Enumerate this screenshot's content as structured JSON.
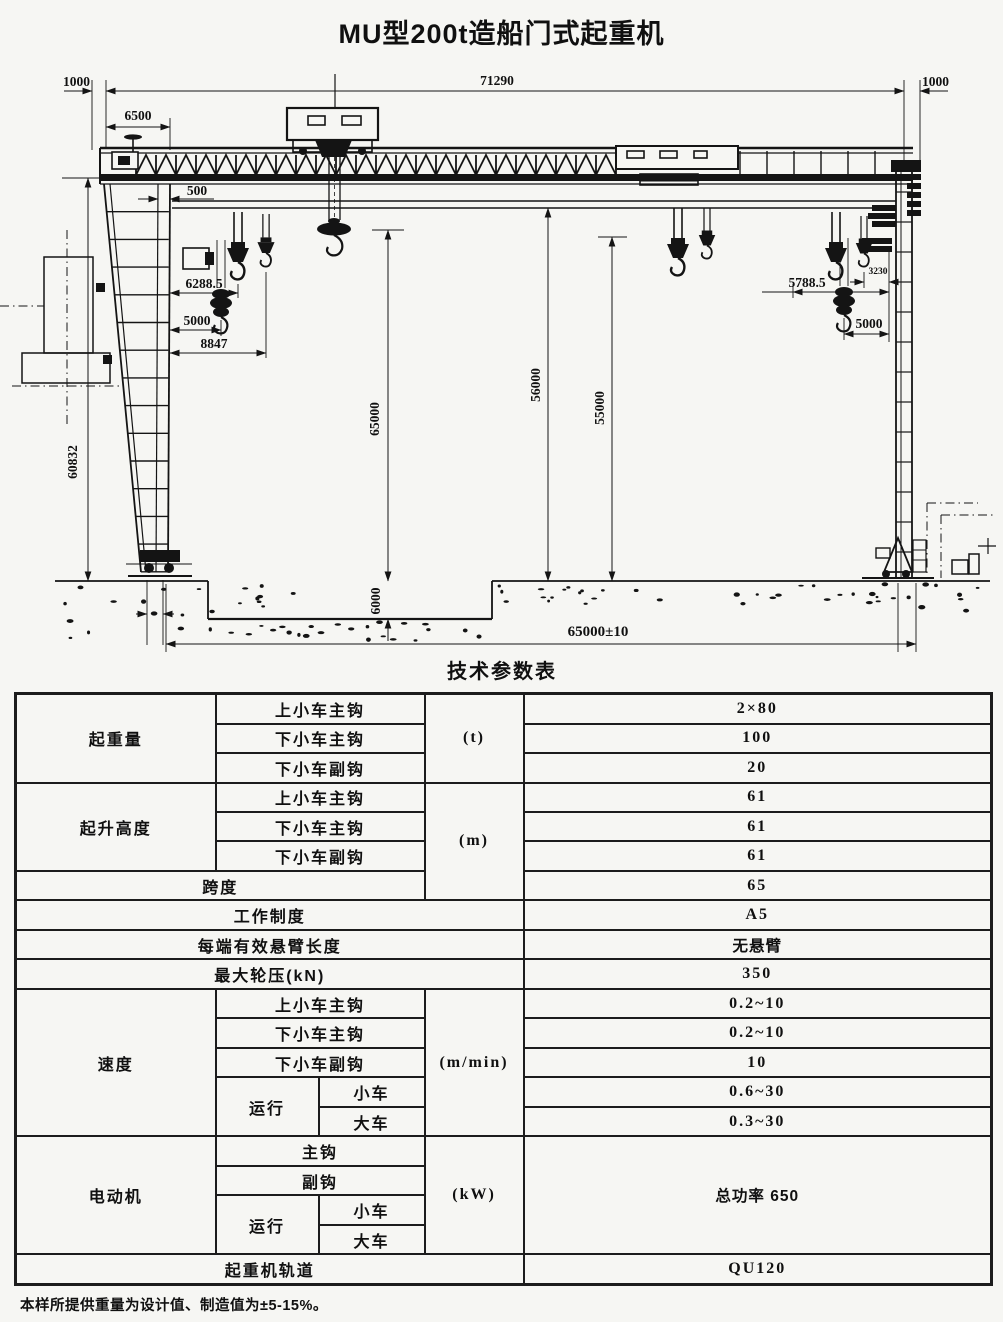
{
  "title": "MU型200t造船门式起重机",
  "dims": {
    "overhang_left": "1000",
    "overall": "71290",
    "overhang_right": "1000",
    "trolley_park": "6500",
    "rail_offset": "500",
    "hook_left_main": "6288.5",
    "hook_left_aux": "5000",
    "hook_left_outer": "8847",
    "hook_right_main": "5788.5",
    "hook_right_small": "3230",
    "hook_right_aux": "5000",
    "height_left": "60832",
    "hoist_mid": "65000",
    "pit_depth": "6000",
    "height_mid": "56000",
    "height_right": "55000",
    "rail_span": "65000±10"
  },
  "table": {
    "title": "技术参数表",
    "capacity": {
      "label": "起重量",
      "unit": "(t)",
      "r1": {
        "item": "上小车主钩",
        "value": "2×80"
      },
      "r2": {
        "item": "下小车主钩",
        "value": "100"
      },
      "r3": {
        "item": "下小车副钩",
        "value": "20"
      }
    },
    "height": {
      "label": "起升高度",
      "unit": "(m)",
      "r1": {
        "item": "上小车主钩",
        "value": "61"
      },
      "r2": {
        "item": "下小车主钩",
        "value": "61"
      },
      "r3": {
        "item": "下小车副钩",
        "value": "61"
      }
    },
    "span": {
      "label": "跨度",
      "value": "65"
    },
    "duty": {
      "label": "工作制度",
      "value": "A5"
    },
    "cantilever": {
      "label": "每端有效悬臂长度",
      "value": "无悬臂"
    },
    "wheel_load": {
      "label": "最大轮压(kN)",
      "value": "350"
    },
    "speed": {
      "label": "速度",
      "unit": "(m/min)",
      "r1": {
        "item": "上小车主钩",
        "value": "0.2~10"
      },
      "r2": {
        "item": "下小车主钩",
        "value": "0.2~10"
      },
      "r3": {
        "item": "下小车副钩",
        "value": "10"
      },
      "travel": {
        "label": "运行",
        "r1": {
          "item": "小车",
          "value": "0.6~30"
        },
        "r2": {
          "item": "大车",
          "value": "0.3~30"
        }
      }
    },
    "motor": {
      "label": "电动机",
      "unit": "(kW)",
      "value": "总功率 650",
      "r1": {
        "item": "主钩"
      },
      "r2": {
        "item": "副钩"
      },
      "travel": {
        "label": "运行",
        "r1": {
          "item": "小车"
        },
        "r2": {
          "item": "大车"
        }
      }
    },
    "rail": {
      "label": "起重机轨道",
      "value": "QU120"
    },
    "footnote": "本样所提供重量为设计值、制造值为±5-15%。"
  }
}
